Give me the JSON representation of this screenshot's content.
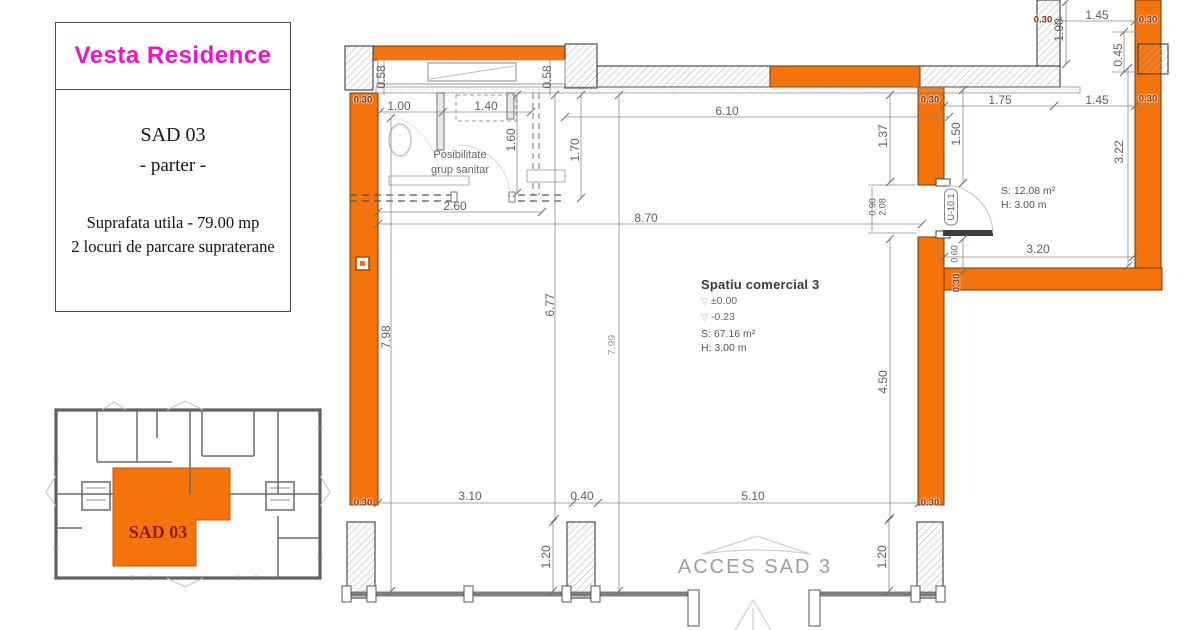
{
  "info_card": {
    "brand": "Vesta Residence",
    "unit": "SAD 03",
    "floor": "- parter -",
    "area_line": "Suprafata utila - 79.00 mp",
    "parking_line": "2 locuri de parcare supraterane"
  },
  "overview": {
    "unit_label": "SAD 03"
  },
  "room_main": {
    "name": "Spatiu comercial 3",
    "level_upper": "±0.00",
    "level_lower": "-0.23",
    "area": "S: 67.16 m²",
    "height": "H: 3.00 m"
  },
  "room_side": {
    "area": "S: 12.08 m²",
    "height": "H: 3.00 m"
  },
  "bathroom_note": {
    "line1": "Posibilitate",
    "line2": "grup sanitar"
  },
  "access_label": "ACCES SAD 3",
  "door": {
    "label": "U-10.1"
  },
  "colors": {
    "accent_orange": "#F4730B",
    "brand_magenta": "#F012D0",
    "wall_mark": "#7D2F0E"
  },
  "dims": [
    {
      "t": "1.00",
      "x": 399,
      "y": 106
    },
    {
      "t": "1.40",
      "x": 486,
      "y": 106
    },
    {
      "t": "6.10",
      "x": 727,
      "y": 111
    },
    {
      "t": "0.58",
      "x": 381,
      "y": 77,
      "r": 1
    },
    {
      "t": "0.58",
      "x": 547,
      "y": 77,
      "r": 1
    },
    {
      "t": "1.60",
      "x": 511,
      "y": 140,
      "r": 1
    },
    {
      "t": "1.70",
      "x": 575,
      "y": 150,
      "r": 1
    },
    {
      "t": "2.60",
      "x": 455,
      "y": 206
    },
    {
      "t": "8.70",
      "x": 646,
      "y": 218
    },
    {
      "t": "1.37",
      "x": 883,
      "y": 136,
      "r": 1
    },
    {
      "t": "1.50",
      "x": 956,
      "y": 134,
      "r": 1
    },
    {
      "t": "0.90",
      "x": 873,
      "y": 207,
      "r": 1,
      "c": "s"
    },
    {
      "t": "2.08",
      "x": 883,
      "y": 207,
      "r": 1,
      "c": "s"
    },
    {
      "t": "0.60",
      "x": 955,
      "y": 254,
      "r": 1,
      "c": "s"
    },
    {
      "t": "7.98",
      "x": 386,
      "y": 337,
      "r": 1
    },
    {
      "t": "6.77",
      "x": 550,
      "y": 305,
      "r": 1
    },
    {
      "t": "7.99",
      "x": 612,
      "y": 345,
      "r": 1,
      "c": "f"
    },
    {
      "t": "4.50",
      "x": 883,
      "y": 382,
      "r": 1
    },
    {
      "t": "3.10",
      "x": 470,
      "y": 496
    },
    {
      "t": "0.40",
      "x": 582,
      "y": 496
    },
    {
      "t": "5.10",
      "x": 753,
      "y": 496
    },
    {
      "t": "1.20",
      "x": 546,
      "y": 557,
      "r": 1
    },
    {
      "t": "1.20",
      "x": 882,
      "y": 557,
      "r": 1
    },
    {
      "t": "1.75",
      "x": 1000,
      "y": 100
    },
    {
      "t": "1.45",
      "x": 1097,
      "y": 100
    },
    {
      "t": "1.45",
      "x": 1097,
      "y": 15
    },
    {
      "t": "1.90",
      "x": 1059,
      "y": 30,
      "r": 1
    },
    {
      "t": "0.45",
      "x": 1118,
      "y": 55,
      "r": 1
    },
    {
      "t": "3.22",
      "x": 1119,
      "y": 152,
      "r": 1
    },
    {
      "t": "3.20",
      "x": 1038,
      "y": 249
    }
  ],
  "wall_marks": [
    {
      "t": "0.30",
      "x": 363,
      "y": 100,
      "c": "m"
    },
    {
      "t": "0.30",
      "x": 363,
      "y": 503,
      "c": "m"
    },
    {
      "t": "0.30",
      "x": 930,
      "y": 100,
      "c": "m"
    },
    {
      "t": "0.30",
      "x": 930,
      "y": 503,
      "c": "m"
    },
    {
      "t": "0.30",
      "x": 1043,
      "y": 20,
      "c": "m"
    },
    {
      "t": "0.30",
      "x": 1148,
      "y": 20,
      "c": "m"
    },
    {
      "t": "0.30",
      "x": 1148,
      "y": 99,
      "c": "m"
    },
    {
      "t": "0.30",
      "x": 957,
      "y": 283,
      "r": 1,
      "c": "m"
    }
  ]
}
